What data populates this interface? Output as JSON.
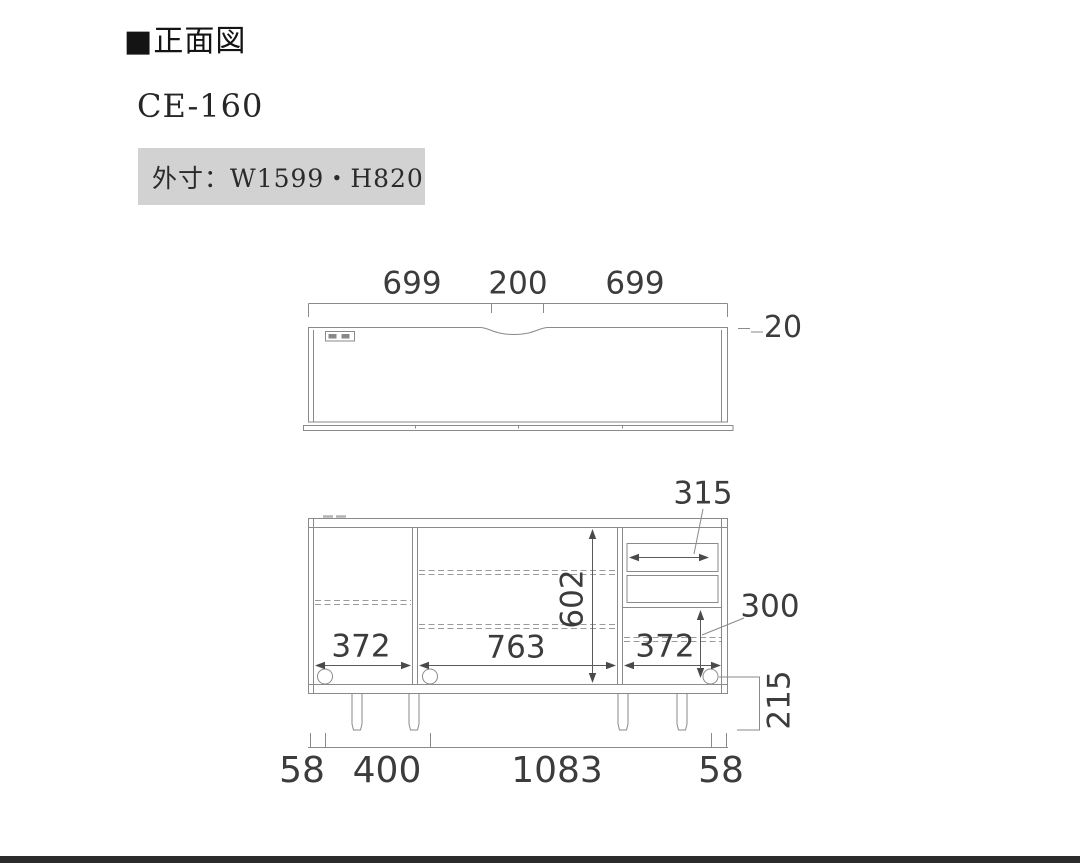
{
  "header": {
    "title": "■正面図",
    "model": "CE-160",
    "outer_size": "外寸：W1599・H820"
  },
  "top_view": {
    "width_left": "699",
    "width_center": "200",
    "width_right": "699",
    "top_thickness": "20"
  },
  "front_view": {
    "drawer_inner_width": "315",
    "inner_height": "602",
    "right_open_height": "300",
    "left_section_width": "372",
    "center_section_width": "763",
    "right_section_width": "372",
    "leg_height": "215",
    "base_offset_left": "58",
    "leg_span_left": "400",
    "leg_span_center": "1083",
    "base_offset_right": "58"
  }
}
